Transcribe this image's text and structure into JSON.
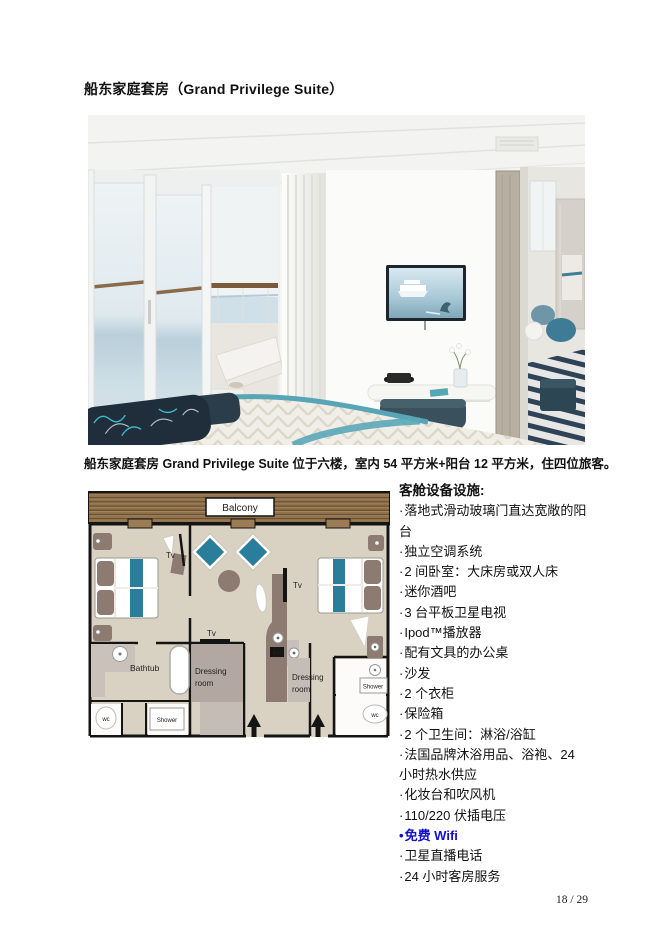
{
  "page": {
    "title": "船东家庭套房（Grand Privilege Suite）",
    "caption": "船东家庭套房 Grand Privilege Suite 位于六楼，室内 54 平方米+阳台 12 平方米，住四位旅客。",
    "page_number": "18 / 29"
  },
  "colors": {
    "wifi_blue": "#1111cc",
    "teal_accent": "#2b7e9b",
    "balcony_wood": "#91744f",
    "plan_floor": "#d9d2c3",
    "furniture_taupe": "#8d7b72"
  },
  "floorplan": {
    "labels": {
      "balcony": "Balcony",
      "tv": "Tv",
      "bathtub": "Bathtub",
      "dressing_line1": "Dressing",
      "dressing_line2": "room",
      "bar": "Bar",
      "shower": "Shower",
      "wc": "wc"
    }
  },
  "amenities": {
    "header": "客舱设备设施:",
    "items": [
      {
        "bullet": "·",
        "text": "落地式滑动玻璃门直达宽敞的阳台"
      },
      {
        "bullet": "·",
        "text": "独立空调系统"
      },
      {
        "bullet": "·",
        "text": "2 间卧室：大床房或双人床"
      },
      {
        "bullet": "·",
        "text": "迷你酒吧"
      },
      {
        "bullet": "·",
        "text": "3 台平板卫星电视"
      },
      {
        "bullet": "·",
        "text": "Ipod™播放器"
      },
      {
        "bullet": "·",
        "text": "配有文具的办公桌"
      },
      {
        "bullet": "·",
        "text": "沙发"
      },
      {
        "bullet": "·",
        "text": "2 个衣柜"
      },
      {
        "bullet": "·",
        "text": "保险箱"
      },
      {
        "bullet": "·",
        "text": "2 个卫生间：淋浴/浴缸"
      },
      {
        "bullet": "·",
        "text": "法国品牌沐浴用品、浴袍、24 小时热水供应"
      },
      {
        "bullet": "·",
        "text": "化妆台和吹风机"
      },
      {
        "bullet": "·",
        "text": "110/220 伏插电压"
      },
      {
        "bullet": "•",
        "text": "免费 Wifi"
      },
      {
        "bullet": "·",
        "text": "卫星直播电话"
      },
      {
        "bullet": "·",
        "text": "24 小时客房服务"
      }
    ]
  }
}
